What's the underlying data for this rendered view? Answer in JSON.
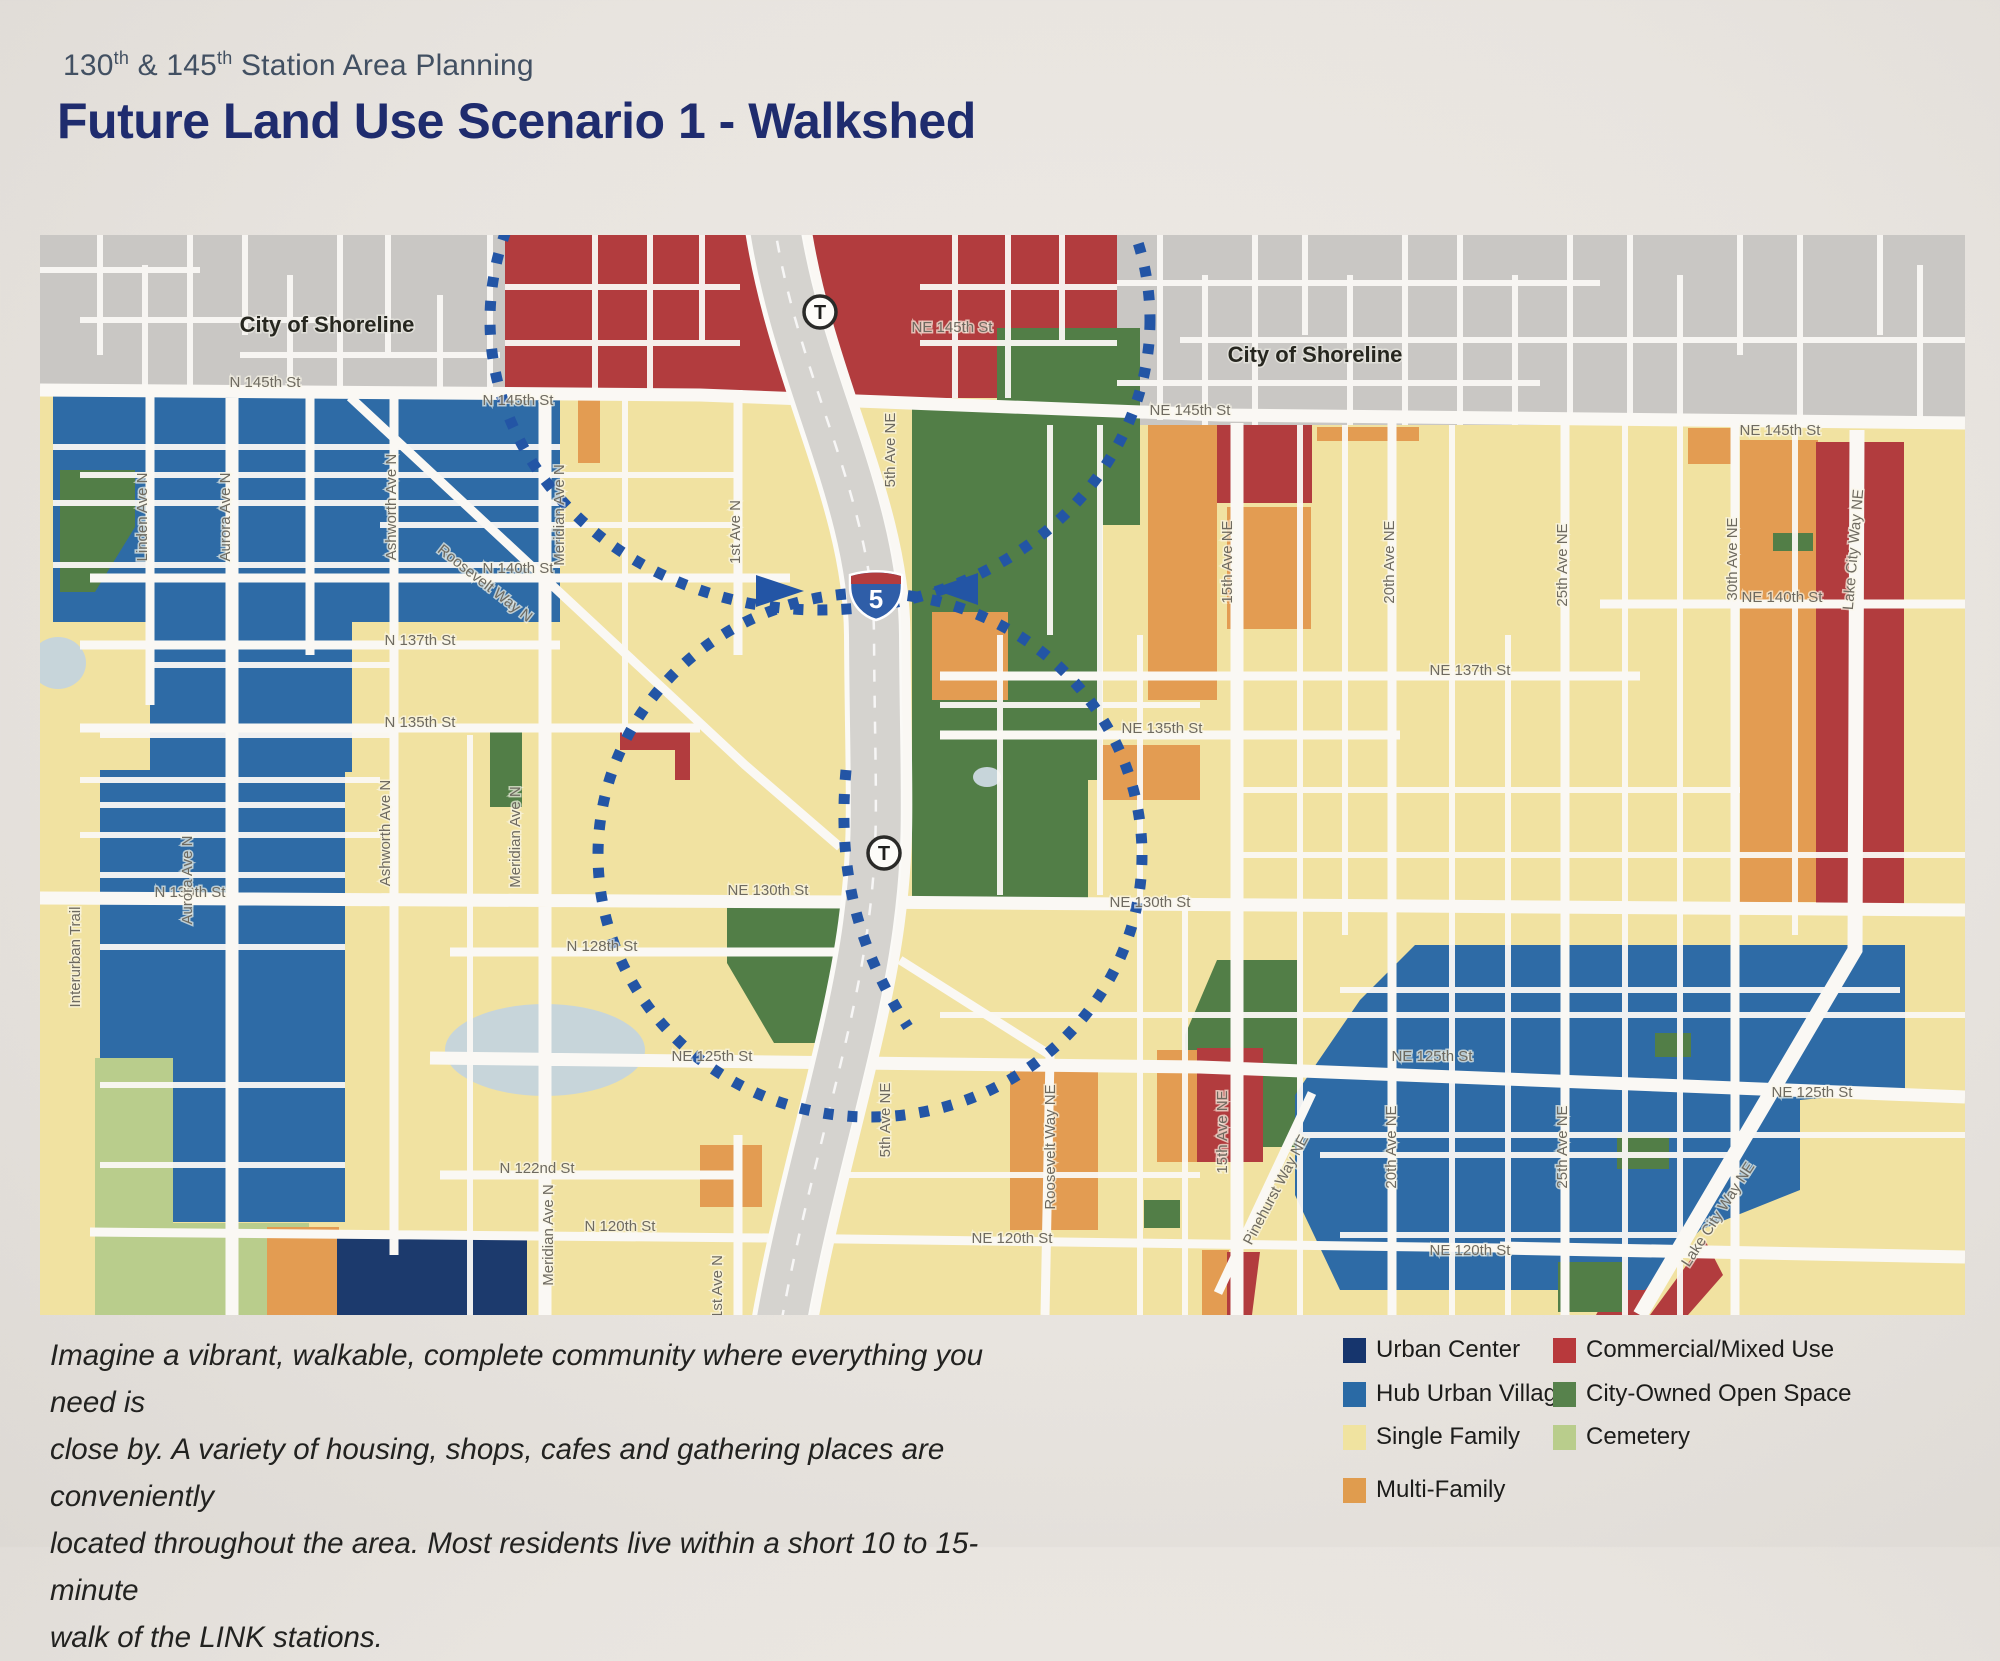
{
  "header": {
    "subtitle": {
      "p1": "130",
      "sup1": "th",
      "p2": " & 145",
      "sup2": "th",
      "p3": " Station Area Planning"
    },
    "title": "Future Land Use Scenario 1 - Walkshed"
  },
  "description": {
    "line1": "Imagine a vibrant, walkable, complete community where everything you need is",
    "line2": "close by. A variety of housing, shops, cafes and gathering places are conveniently",
    "line3": "located throughout the area. Most residents live within a short 10 to 15- minute",
    "line4": "walk of the LINK stations."
  },
  "legend": {
    "items": [
      {
        "label": "Urban Center",
        "color": "#16356d"
      },
      {
        "label": "Hub Urban Village",
        "color": "#2a6aa5"
      },
      {
        "label": "Single Family",
        "color": "#f0e3a0"
      },
      {
        "label": "Multi-Family",
        "color": "#e09c4e"
      },
      {
        "label": "Commercial/Mixed Use",
        "color": "#b8393c"
      },
      {
        "label": "City-Owned Open Space",
        "color": "#57824c"
      },
      {
        "label": "Cemetery",
        "color": "#b9cd8c"
      }
    ]
  },
  "map": {
    "freeway_shield": "5",
    "stations": [
      {
        "label": "T"
      },
      {
        "label": "T"
      }
    ],
    "colors": {
      "walkshed_dash": "#2355a5",
      "single_family": "#f1e2a1",
      "outside_city": "#c9c7c4",
      "water": "#c7d5da",
      "road": "#faf8f4"
    },
    "street_labels": [
      {
        "t": "N 145th St",
        "x": 225,
        "y": 152
      },
      {
        "t": "N 145th St",
        "x": 478,
        "y": 170
      },
      {
        "t": "NE 145th St",
        "x": 912,
        "y": 97
      },
      {
        "t": "NE 145th St",
        "x": 1150,
        "y": 180
      },
      {
        "t": "NE 145th St",
        "x": 1740,
        "y": 200
      },
      {
        "t": "N 140th St",
        "x": 478,
        "y": 338
      },
      {
        "t": "NE 140th St",
        "x": 1742,
        "y": 367
      },
      {
        "t": "N 137th St",
        "x": 380,
        "y": 410
      },
      {
        "t": "NE 137th St",
        "x": 1430,
        "y": 440
      },
      {
        "t": "N 135th St",
        "x": 380,
        "y": 492
      },
      {
        "t": "NE 135th St",
        "x": 1122,
        "y": 498
      },
      {
        "t": "N 130th St",
        "x": 150,
        "y": 662
      },
      {
        "t": "NE 130th St",
        "x": 728,
        "y": 660
      },
      {
        "t": "NE 130th St",
        "x": 1110,
        "y": 672
      },
      {
        "t": "N 128th St",
        "x": 562,
        "y": 716
      },
      {
        "t": "NE 125th St",
        "x": 672,
        "y": 826
      },
      {
        "t": "NE 125th St",
        "x": 1392,
        "y": 826
      },
      {
        "t": "NE 125th St",
        "x": 1772,
        "y": 862
      },
      {
        "t": "N 122nd St",
        "x": 497,
        "y": 938
      },
      {
        "t": "N 120th St",
        "x": 580,
        "y": 996
      },
      {
        "t": "NE 120th St",
        "x": 972,
        "y": 1008
      },
      {
        "t": "NE 120th St",
        "x": 1430,
        "y": 1020
      },
      {
        "t": "Linden Ave N",
        "x": 107,
        "y": 282,
        "r": -90
      },
      {
        "t": "Aurora Ave N",
        "x": 190,
        "y": 282,
        "r": -90
      },
      {
        "t": "Aurora Ave N",
        "x": 152,
        "y": 645,
        "r": -90
      },
      {
        "t": "Ashworth Ave N",
        "x": 356,
        "y": 272,
        "r": -90
      },
      {
        "t": "Ashworth Ave N",
        "x": 350,
        "y": 598,
        "r": -90
      },
      {
        "t": "Meridian Ave N",
        "x": 524,
        "y": 280,
        "r": -90
      },
      {
        "t": "Meridian Ave N",
        "x": 480,
        "y": 602,
        "r": -90
      },
      {
        "t": "Meridian Ave N",
        "x": 513,
        "y": 1000,
        "r": -90
      },
      {
        "t": "1st Ave N",
        "x": 700,
        "y": 297,
        "r": -90
      },
      {
        "t": "1st Ave N",
        "x": 682,
        "y": 1052,
        "r": -90
      },
      {
        "t": "5th Ave NE",
        "x": 855,
        "y": 215,
        "r": -90
      },
      {
        "t": "5th Ave NE",
        "x": 850,
        "y": 885,
        "r": -90
      },
      {
        "t": "15th Ave NE",
        "x": 1192,
        "y": 327,
        "r": -90
      },
      {
        "t": "15th Ave NE",
        "x": 1187,
        "y": 897,
        "r": -90
      },
      {
        "t": "20th Ave NE",
        "x": 1354,
        "y": 327,
        "r": -90
      },
      {
        "t": "20th Ave NE",
        "x": 1356,
        "y": 912,
        "r": -90
      },
      {
        "t": "25th Ave NE",
        "x": 1527,
        "y": 330,
        "r": -90
      },
      {
        "t": "25th Ave NE",
        "x": 1527,
        "y": 912,
        "r": -90
      },
      {
        "t": "30th Ave NE",
        "x": 1697,
        "y": 324,
        "r": -90
      },
      {
        "t": "Interurban Trail",
        "x": 40,
        "y": 722,
        "r": -90
      },
      {
        "t": "Roosevelt Way N",
        "x": 442,
        "y": 352,
        "r": 38
      },
      {
        "t": "Roosevelt Way NE",
        "x": 1015,
        "y": 912,
        "r": -90
      },
      {
        "t": "Pinehurst Way NE",
        "x": 1240,
        "y": 957,
        "r": -62
      },
      {
        "t": "Lake City Way NE",
        "x": 1818,
        "y": 315,
        "r": -85
      },
      {
        "t": "Lake City Way NE",
        "x": 1682,
        "y": 982,
        "r": -57
      },
      {
        "t": "City of Shoreline",
        "x": 287,
        "y": 97,
        "c": "city"
      },
      {
        "t": "City of Shoreline",
        "x": 1275,
        "y": 127,
        "c": "city"
      }
    ]
  }
}
